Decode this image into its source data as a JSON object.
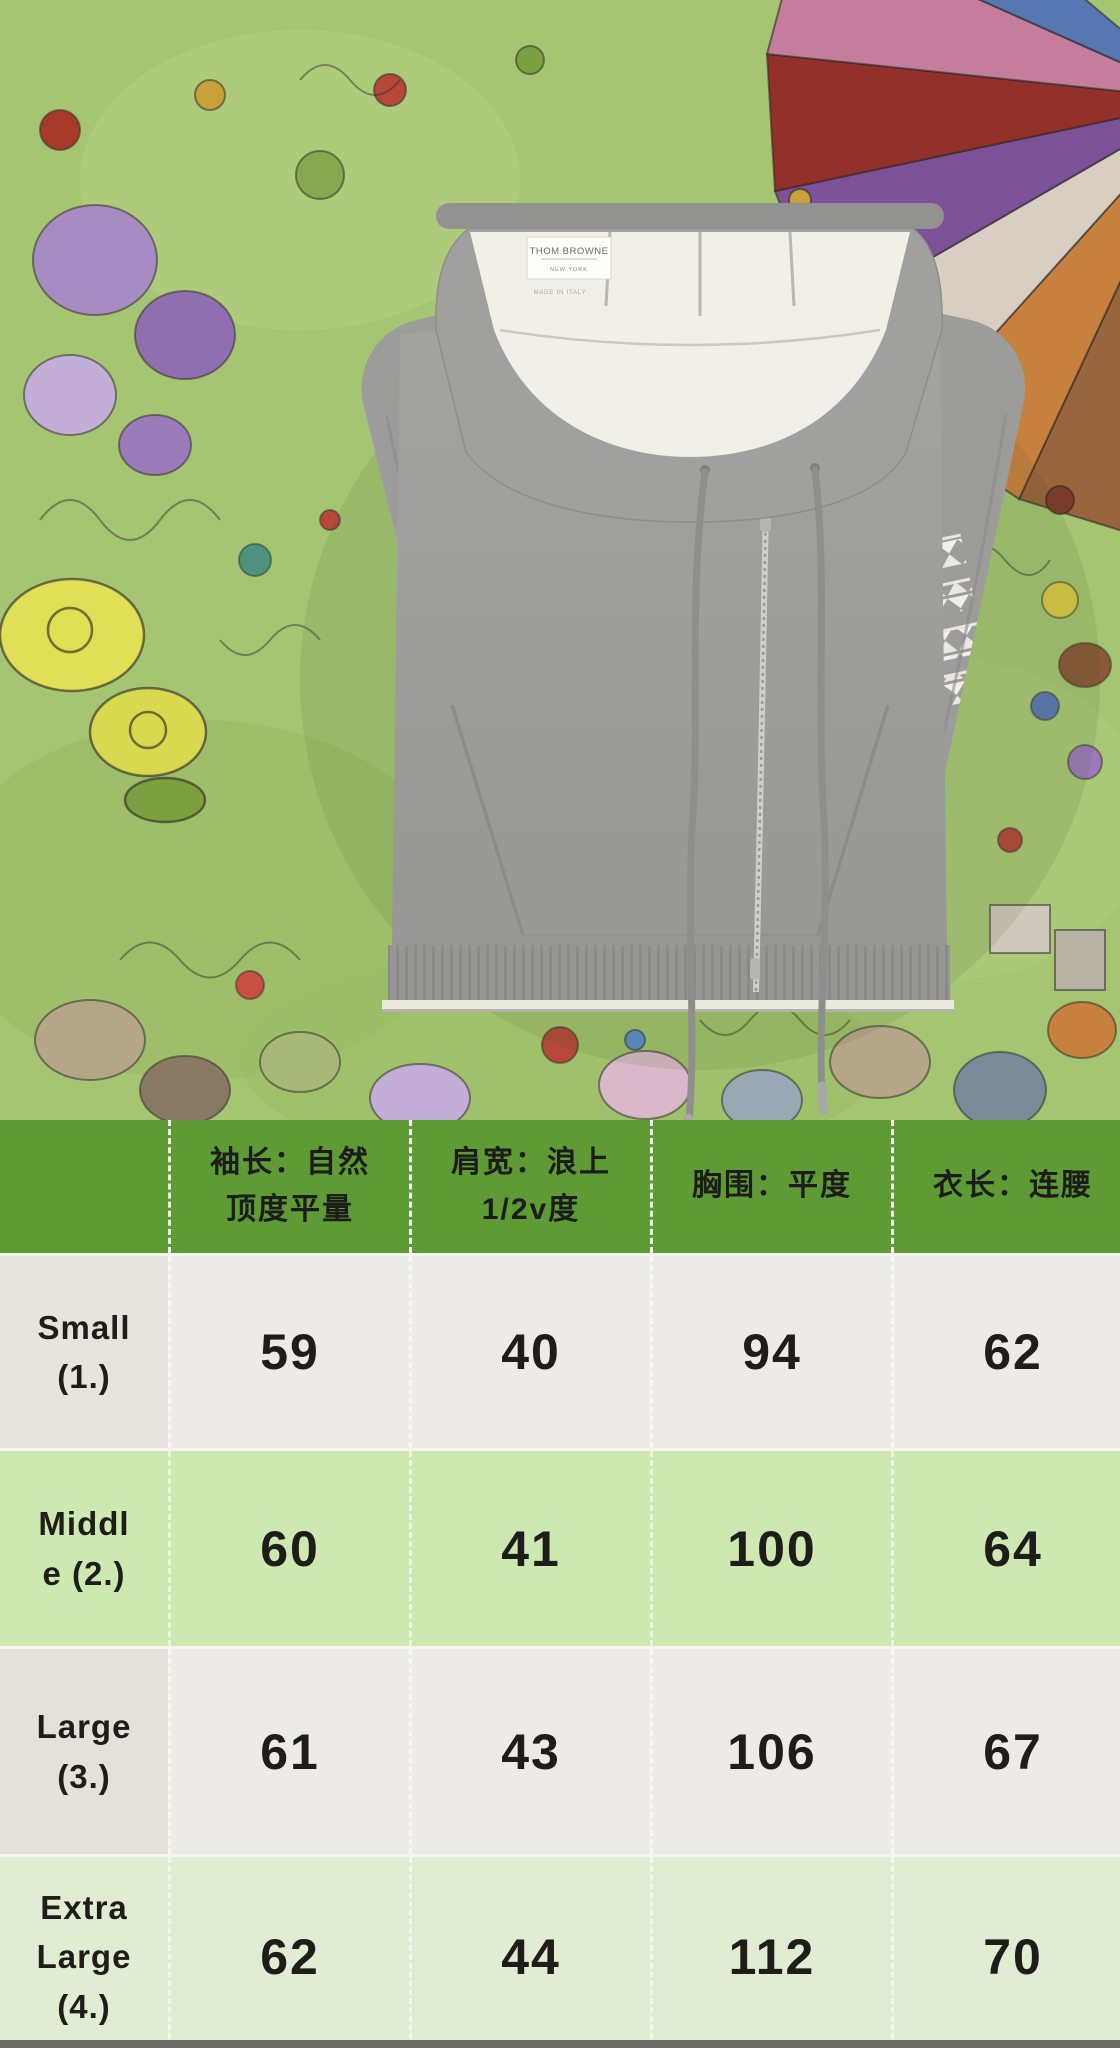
{
  "photo": {
    "garment_label": {
      "brand": "THOM BROWNE",
      "city": "NEW YORK",
      "origin": "MADE IN ITALY"
    },
    "colors": {
      "hoodie_gray": "#9e9e9c",
      "hood_lining": "#f1efe8",
      "hem_tipping": "#eceade",
      "tapestry_green": "#a5c573"
    }
  },
  "size_chart": {
    "colors": {
      "header_bg": "#5e9b34",
      "header_text": "#1c1c1a",
      "row_neutral_bg": "#edebe8",
      "row_green_bg": "#cde8b0",
      "row_pale_green_bg": "#e0edd2",
      "neutral_label_col_bg": "#e7e4df"
    },
    "header": {
      "columns": [
        {
          "label": "",
          "lines": []
        },
        {
          "label": "袖长：自然顶度平量",
          "lines": [
            "袖长：自然",
            "顶度平量"
          ]
        },
        {
          "label": "肩宽：浪上1/2v度",
          "lines": [
            "肩宽：浪上",
            "1/2v度"
          ]
        },
        {
          "label": "胸围：平度",
          "lines": [
            "胸围：平度"
          ]
        },
        {
          "label": "衣长：连腰",
          "lines": [
            "衣长：连腰"
          ]
        }
      ]
    },
    "rows": [
      {
        "size": "Small (1.)",
        "size_lines": [
          "Small",
          "(1.)"
        ],
        "values": [
          "59",
          "40",
          "94",
          "62"
        ]
      },
      {
        "size": "Middle (2.)",
        "size_lines": [
          "Middl",
          "e (2.)"
        ],
        "values": [
          "60",
          "41",
          "100",
          "64"
        ]
      },
      {
        "size": "Large (3.)",
        "size_lines": [
          "Large",
          "(3.)"
        ],
        "values": [
          "61",
          "43",
          "106",
          "67"
        ]
      },
      {
        "size": "Extra Large (4.)",
        "size_lines": [
          "Extra",
          "Large",
          "(4.)"
        ],
        "values": [
          "62",
          "44",
          "112",
          "70"
        ]
      }
    ]
  },
  "chart_data": {
    "type": "table",
    "title": "",
    "columns": [
      "",
      "袖长：自然顶度平量",
      "肩宽：浪上1/2v度",
      "胸围：平度",
      "衣长：连腰"
    ],
    "rows": [
      [
        "Small (1.)",
        59,
        40,
        94,
        62
      ],
      [
        "Middle (2.)",
        60,
        41,
        100,
        64
      ],
      [
        "Large (3.)",
        61,
        43,
        106,
        67
      ],
      [
        "Extra Large (4.)",
        62,
        44,
        112,
        70
      ]
    ]
  }
}
